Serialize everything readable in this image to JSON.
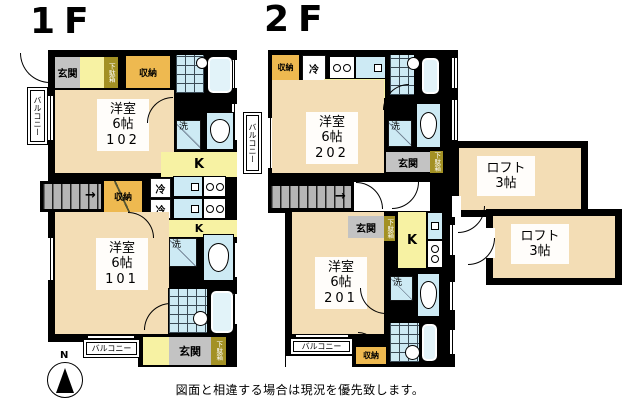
{
  "floor_titles": {
    "f1": "1F",
    "f2": "2F"
  },
  "labels": {
    "entrance": "玄関",
    "storage": "収納",
    "shoe_cabinet": "下駄箱",
    "fridge": "冷",
    "washer": "洗",
    "kitchen": "K",
    "balcony": "バルコニー",
    "compass_north": "N"
  },
  "rooms": {
    "r102": {
      "type": "洋室",
      "size": "6帖",
      "number": "102"
    },
    "r101": {
      "type": "洋室",
      "size": "6帖",
      "number": "101"
    },
    "r202": {
      "type": "洋室",
      "size": "6帖",
      "number": "202"
    },
    "r201": {
      "type": "洋室",
      "size": "6帖",
      "number": "201"
    },
    "loft_upper": {
      "type": "ロフト",
      "size": "3帖"
    },
    "loft_lower": {
      "type": "ロフト",
      "size": "3帖"
    }
  },
  "disclaimer": "図面と相違する場合は現況を優先致します。",
  "colors": {
    "wall": "#000000",
    "room_floor": "#f3ddb5",
    "kitchen": "#f7f2a3",
    "storage": "#eeb950",
    "shoe_cabinet": "#a39124",
    "entrance_floor": "#c3c3c3",
    "stairs": "#b5b5b5",
    "sanitary": "#cdeaf4",
    "background": "#ffffff"
  }
}
